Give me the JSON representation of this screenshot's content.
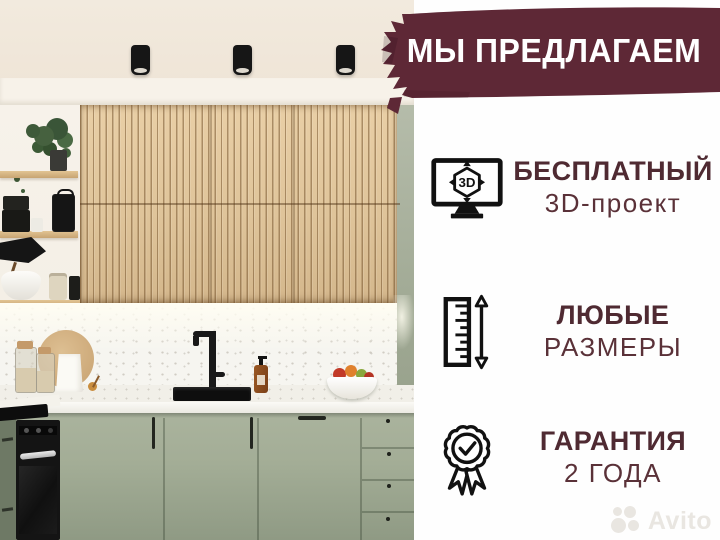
{
  "banner": {
    "label": "МЫ ПРЕДЛАГАЕМ",
    "bg_color": "#5e2836",
    "text_color": "#ffffff"
  },
  "features": [
    {
      "icon": "monitor-3d-icon",
      "icon_label": "3D",
      "title": "БЕСПЛАТНЫЙ",
      "subtitle": "3D-проект"
    },
    {
      "icon": "ruler-height-icon",
      "title": "ЛЮБЫЕ",
      "subtitle": "РАЗМЕРЫ"
    },
    {
      "icon": "warranty-badge-icon",
      "title": "ГАРАНТИЯ",
      "subtitle": "2 ГОДА"
    }
  ],
  "watermark": {
    "label": "Avito"
  },
  "colors": {
    "banner_bg": "#5e2836",
    "feature_title": "#4f2a32",
    "feature_subtitle": "#5a3138",
    "panel_bg": "#fefefe",
    "cabinet_green": "#a6b099",
    "wood_slats": "#dec299",
    "icon_stroke": "#111111"
  }
}
